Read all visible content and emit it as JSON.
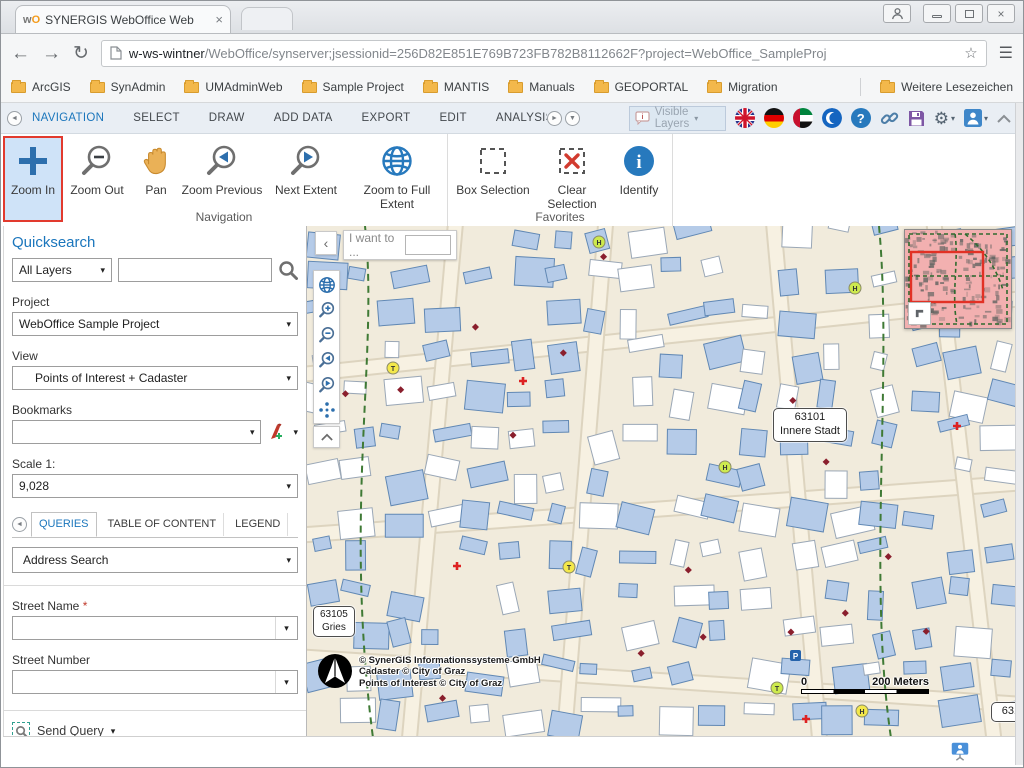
{
  "glyphs": {
    "caret": "▾",
    "back": "←",
    "forward": "→",
    "reload": "↻",
    "menu": "☰",
    "star": "☆",
    "close": "×",
    "left_small": "◄",
    "right_small": "►",
    "down_small": "▼",
    "chevron_left": "‹",
    "gear": "⚙",
    "question": "?",
    "info": "i"
  },
  "browser": {
    "tab_title": "SYNERGIS WebOffice Web",
    "url_host": "w-ws-wintner",
    "url_rest": "/WebOffice/synserver;jsessionid=256D82E851E769B723FB782B8112662F?project=WebOffice_SampleProj",
    "bookmarks": [
      "ArcGIS",
      "SynAdmin",
      "UMAdminWeb",
      "Sample Project",
      "MANTIS",
      "Manuals",
      "GEOPORTAL",
      "Migration"
    ],
    "more_bookmarks": "Weitere Lesezeichen"
  },
  "ribbon": {
    "tabs": [
      "NAVIGATION",
      "SELECT",
      "DRAW",
      "ADD DATA",
      "EXPORT",
      "EDIT",
      "ANALYSIS",
      "REMAINING"
    ],
    "visible_layers": "Visible Layers"
  },
  "toolbar": {
    "zoom_in": "Zoom In",
    "zoom_out": "Zoom Out",
    "pan": "Pan",
    "zoom_previous": "Zoom Previous",
    "next_extent": "Next Extent",
    "zoom_full": "Zoom to Full Extent",
    "box_selection": "Box Selection",
    "clear_selection": "Clear Selection",
    "identify": "Identify",
    "group_navigation": "Navigation",
    "group_favorites": "Favorites",
    "synergis": "synergis",
    "esri": "esri",
    "esri_sub1": "Official",
    "esri_sub2": "Distributor"
  },
  "sidebar": {
    "quicksearch": "Quicksearch",
    "all_layers": "All Layers",
    "project_label": "Project",
    "project_value": "WebOffice Sample Project",
    "view_label": "View",
    "view_value": "Points of Interest + Cadaster",
    "bookmarks_label": "Bookmarks",
    "scale_label": "Scale 1:",
    "scale_value": "9,028",
    "tab_queries": "QUERIES",
    "tab_toc": "TABLE OF CONTENT",
    "tab_legend": "LEGEND",
    "tab_clipped": "L",
    "query_type": "Address Search",
    "street_name_label": "Street Name",
    "required_mark": "*",
    "street_number_label": "Street Number",
    "send_query": "Send Query"
  },
  "map": {
    "i_want_to": "I want to ...",
    "district1_code": "63101",
    "district1_name": "Innere Stadt",
    "district2_code": "63105",
    "district2_name": "Gries",
    "district3_code": "6310",
    "copyright1": "© SynerGIS Informationssysteme GmbH",
    "copyright2": "Cadaster © City of Graz",
    "copyright3": "Points of Interest © City of Graz",
    "scale_zero": "0",
    "scale_distance": "200 Meters",
    "marker_letters": [
      "H",
      "T",
      "H",
      "T",
      "H",
      "H",
      "T"
    ]
  }
}
